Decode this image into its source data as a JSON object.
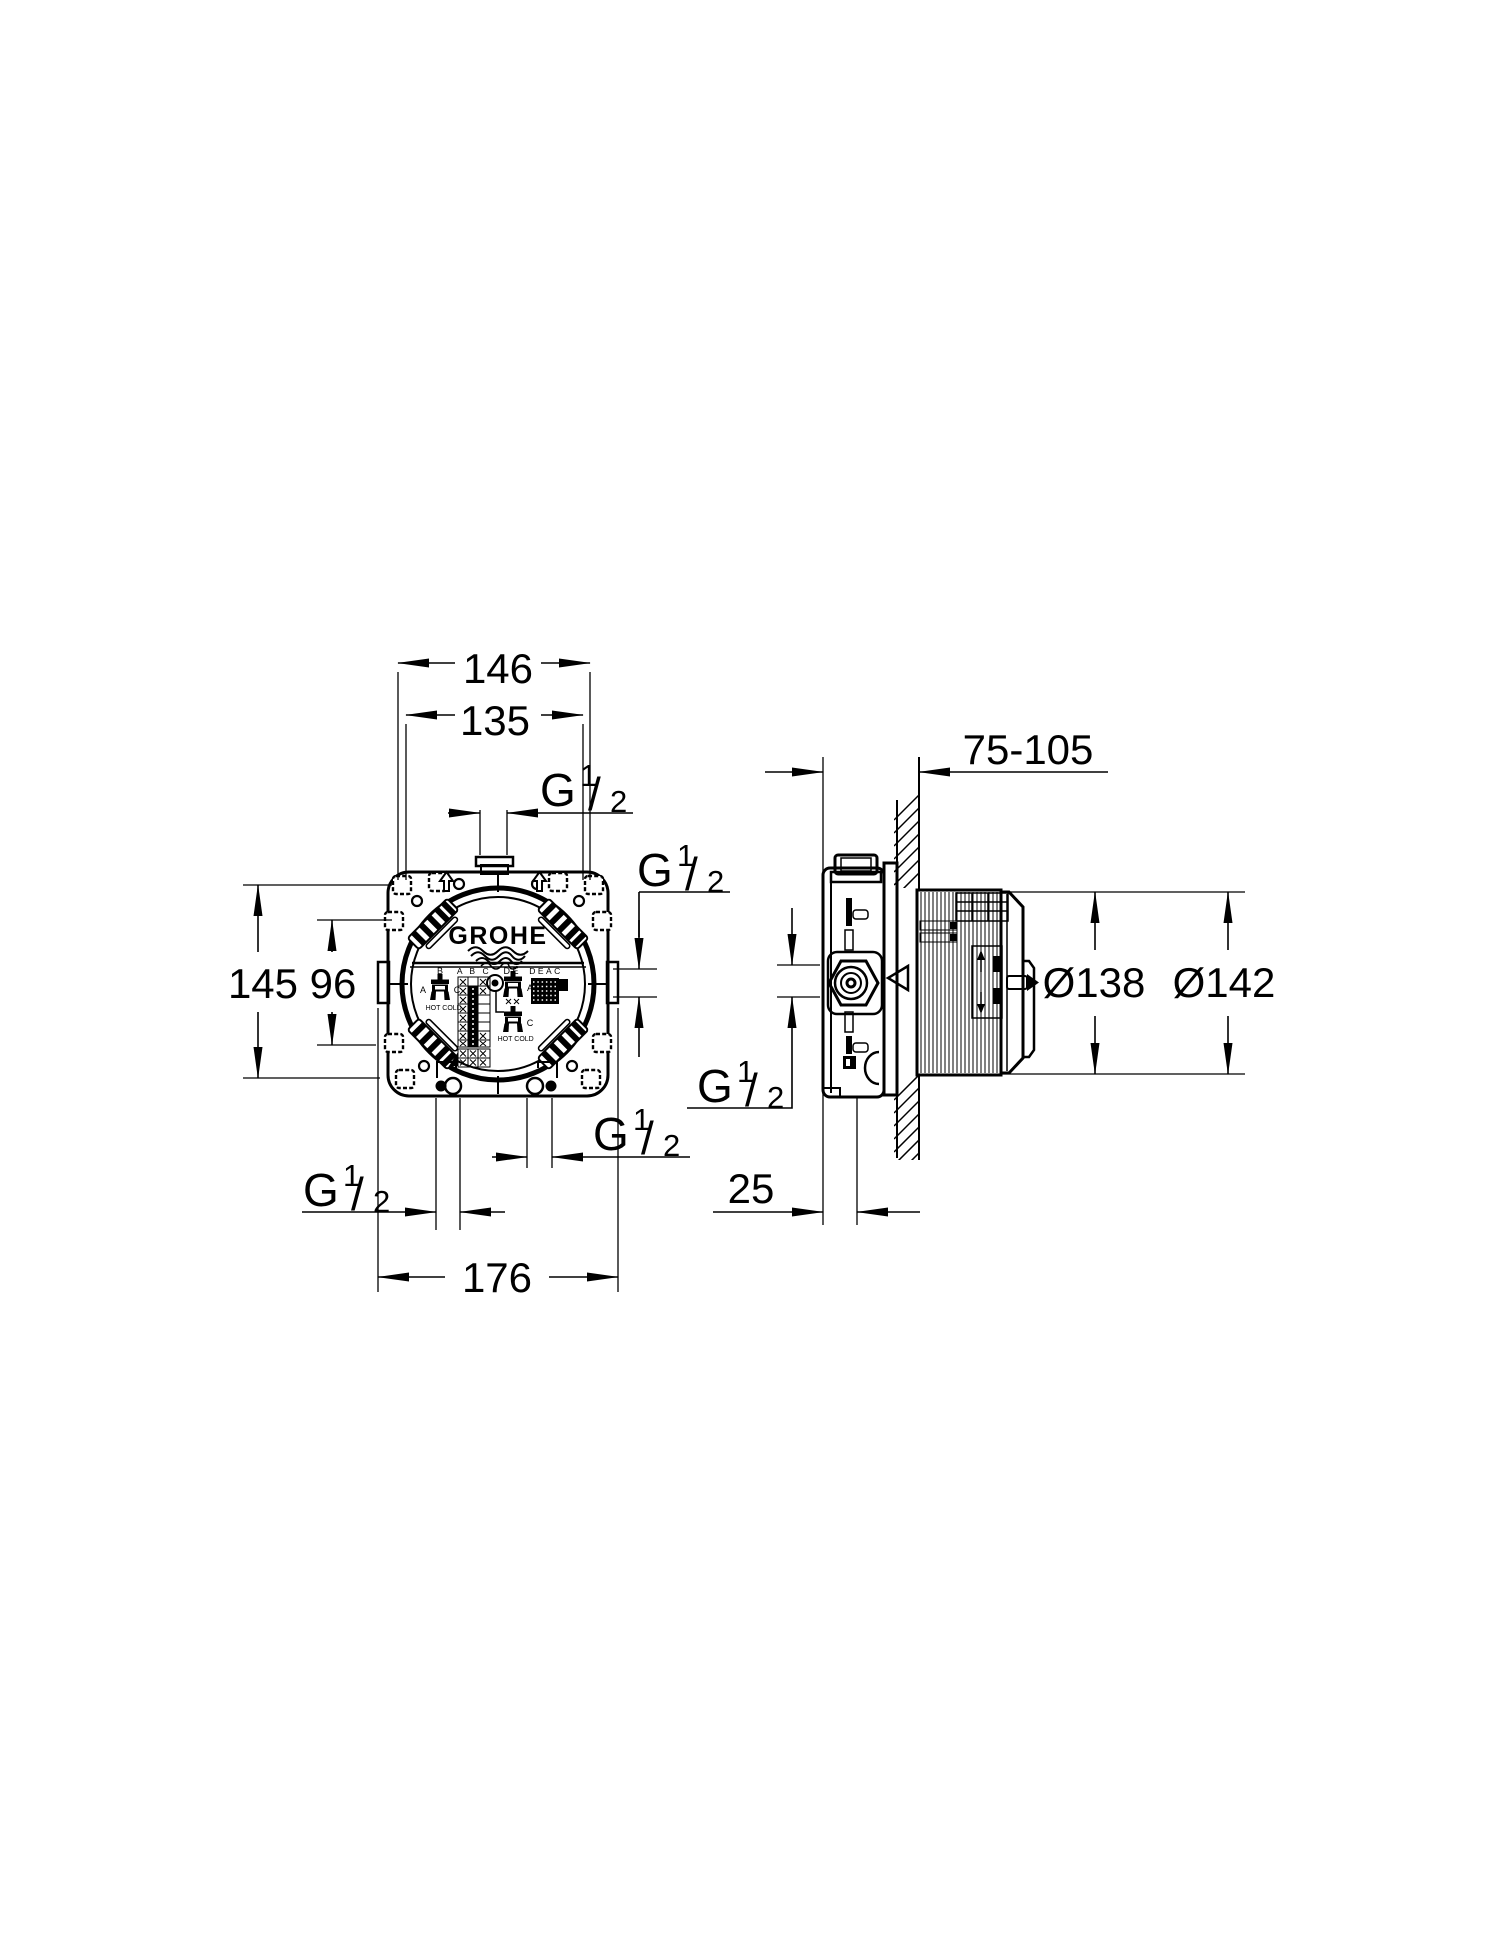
{
  "front_view": {
    "logo": "GROHE",
    "sticker": {
      "valve1_top": "B",
      "valve1_left": "A",
      "valve1_right": "C",
      "valve1_hot": "HOT",
      "valve1_cold": "COLD",
      "matrix_header": "A B C",
      "valve2_top": "D E",
      "valve2_right": "A",
      "block_header": "DEAC",
      "valve3_right": "C",
      "valve3_hot": "HOT",
      "valve3_cold": "COLD"
    }
  },
  "dimensions": {
    "mount_hole_spacing_outer": "146",
    "mount_hole_spacing_inner": "135",
    "height_outer": "145",
    "height_inner": "96",
    "overall_width": "176",
    "install_depth_range": "75-105",
    "body_diameter": "Ø138",
    "flange_diameter": "Ø142",
    "front_depth": "25",
    "thread": {
      "prefix": "G",
      "numerator": "1",
      "slash": "/",
      "denominator": "2"
    }
  }
}
